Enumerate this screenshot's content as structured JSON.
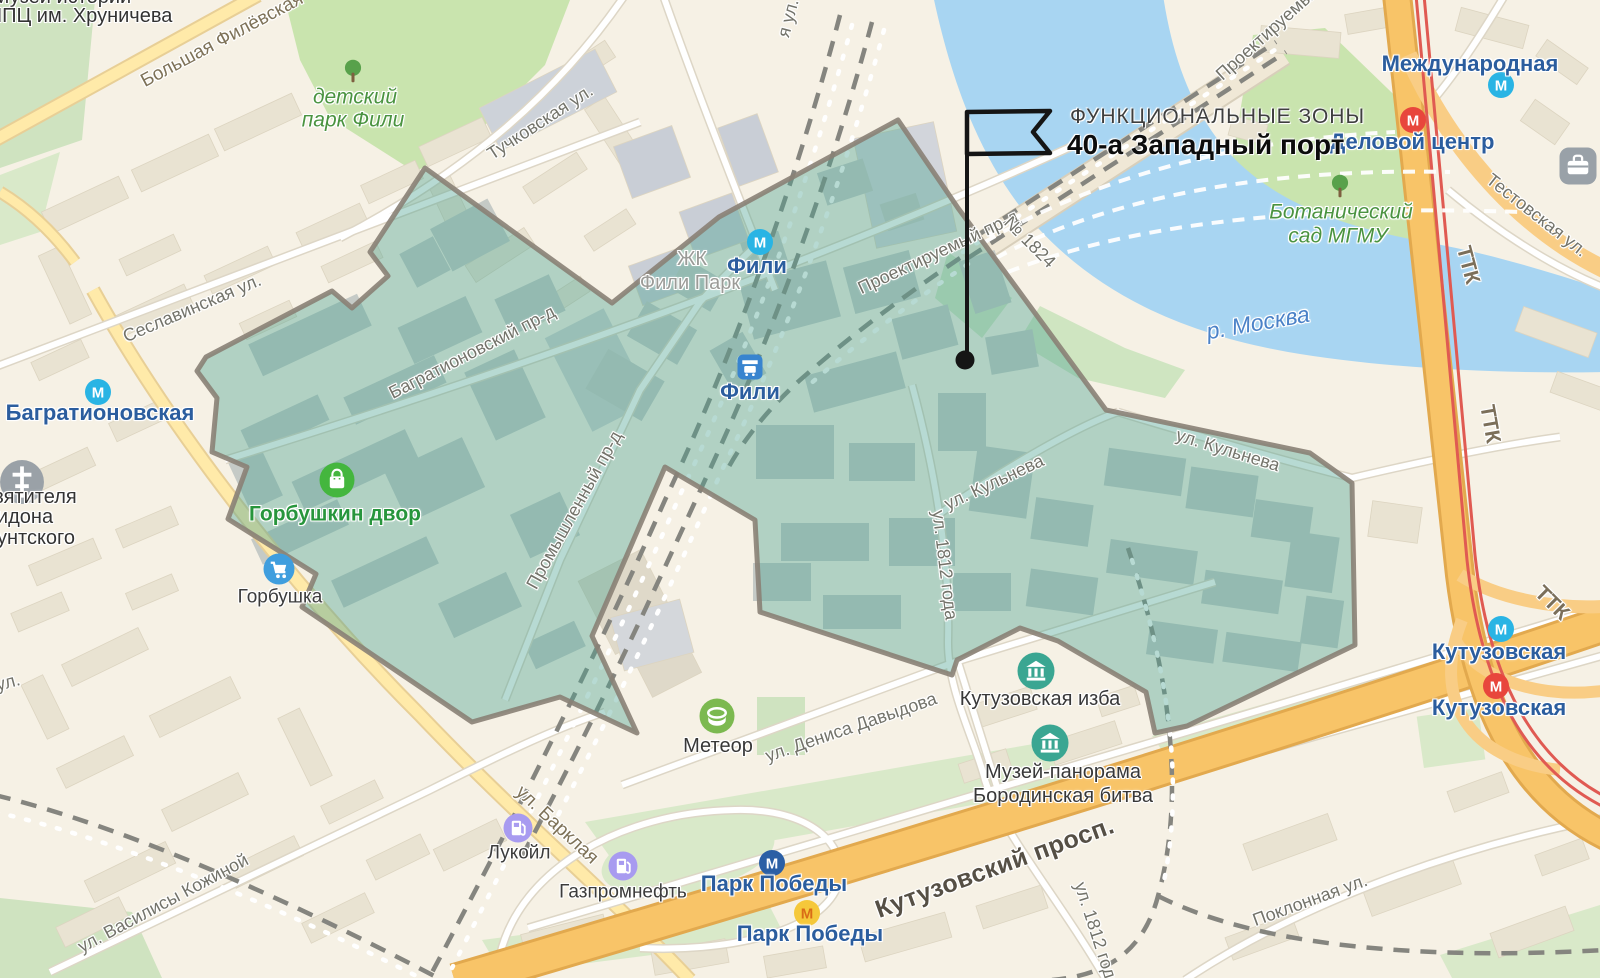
{
  "annotation": {
    "kicker": "ФУНКЦИОНАЛЬНЫЕ ЗОНЫ",
    "title": "40-а Западный порт"
  },
  "zone": {
    "name": "40-а Западный порт",
    "fill": "rgba(75,162,146,0.4)",
    "stroke": "#8a8175"
  },
  "map": {
    "labels": [
      {
        "name": "poi-label-museum-history-line1",
        "text": "Музей истории",
        "x": 62,
        "y": -3,
        "rot": 0,
        "cls": "dark",
        "inter": false
      },
      {
        "name": "poi-label-museum-history-line2",
        "text": "НПЦ им. Хруничева",
        "x": 80,
        "y": 16,
        "rot": 0,
        "cls": "dark",
        "inter": false
      },
      {
        "name": "road-label-bolshaya-filyovskaya",
        "text": "Большая Филёвская",
        "x": 222,
        "y": 40,
        "rot": -28,
        "cls": "road",
        "inter": false
      },
      {
        "name": "park-label-detskiy-line1",
        "text": "детский",
        "x": 355,
        "y": 97,
        "rot": 0,
        "cls": "park",
        "inter": true
      },
      {
        "name": "park-label-detskiy-line2",
        "text": "парк Фили",
        "x": 353,
        "y": 120,
        "rot": 0,
        "cls": "park",
        "inter": true
      },
      {
        "name": "street-label-tuchkovskaya",
        "text": "Тучковская ул.",
        "x": 540,
        "y": 122,
        "rot": -33,
        "cls": "street",
        "inter": false
      },
      {
        "name": "street-label-ya-ul",
        "text": "я ул.",
        "x": 788,
        "y": 18,
        "rot": -75,
        "cls": "street",
        "inter": false
      },
      {
        "name": "street-label-seslavinskaya",
        "text": "Сеславинская ул.",
        "x": 192,
        "y": 308,
        "rot": -23,
        "cls": "street",
        "inter": false
      },
      {
        "name": "metro-label-bagrationovskaya",
        "text": "Багратионовская",
        "x": 100,
        "y": 413,
        "rot": 0,
        "cls": "metro",
        "inter": true
      },
      {
        "name": "poi-label-church-line1",
        "text": "вятителя",
        "x": 35,
        "y": 497,
        "rot": 0,
        "cls": "dark",
        "inter": false
      },
      {
        "name": "poi-label-church-line2",
        "text": "идона",
        "x": 25,
        "y": 517,
        "rot": 0,
        "cls": "dark",
        "inter": false
      },
      {
        "name": "poi-label-church-line3",
        "text": "унтского",
        "x": 36,
        "y": 538,
        "rot": 0,
        "cls": "dark",
        "inter": false
      },
      {
        "name": "street-label-ul-left",
        "text": "ул.",
        "x": 8,
        "y": 682,
        "rot": -15,
        "cls": "street",
        "inter": false
      },
      {
        "name": "road-label-barklaya",
        "text": "ул. Барклая",
        "x": 557,
        "y": 825,
        "rot": 43,
        "cls": "road",
        "inter": false
      },
      {
        "name": "street-label-vasilisy-kozhinoy",
        "text": "ул. Василисы Кожиной",
        "x": 163,
        "y": 903,
        "rot": -28,
        "cls": "street",
        "inter": false
      },
      {
        "name": "poi-label-gorbushkin-dvor",
        "text": "Горбушкин двор",
        "x": 335,
        "y": 514,
        "rot": 0,
        "cls": "green-poi",
        "inter": true
      },
      {
        "name": "poi-label-gorbushka",
        "text": "Горбушка",
        "x": 280,
        "y": 597,
        "rot": 0,
        "cls": "poi",
        "inter": true
      },
      {
        "name": "poi-label-zhk-line1",
        "text": "ЖК",
        "x": 692,
        "y": 259,
        "rot": 0,
        "cls": "gray",
        "inter": false
      },
      {
        "name": "poi-label-zhk-line2",
        "text": "Фили Парк",
        "x": 690,
        "y": 283,
        "rot": 0,
        "cls": "gray",
        "inter": false
      },
      {
        "name": "metro-label-fili",
        "text": "Фили",
        "x": 757,
        "y": 266,
        "rot": 0,
        "cls": "metro",
        "inter": true
      },
      {
        "name": "station-label-fili",
        "text": "Фили",
        "x": 750,
        "y": 392,
        "rot": 0,
        "cls": "metro",
        "inter": true
      },
      {
        "name": "street-label-bagrationovsky",
        "text": "Багратионовский пр-д",
        "x": 472,
        "y": 352,
        "rot": -27,
        "cls": "street",
        "inter": false
      },
      {
        "name": "street-label-promyshlenny",
        "text": "Промышленный пр-д",
        "x": 574,
        "y": 510,
        "rot": -61,
        "cls": "street",
        "inter": false
      },
      {
        "name": "street-label-proektiruemy",
        "text": "Проектируемый пр-д",
        "x": 938,
        "y": 252,
        "rot": -25,
        "cls": "street",
        "inter": false
      },
      {
        "name": "street-label-proektiruemy-num",
        "text": "№ 1824",
        "x": 1030,
        "y": 242,
        "rot": 45,
        "cls": "street",
        "inter": false
      },
      {
        "name": "street-label-proektiruemy-2",
        "text": "Проектируемый",
        "x": 1268,
        "y": 32,
        "rot": -42,
        "cls": "street",
        "inter": false
      },
      {
        "name": "water-label-moskva",
        "text": "р. Москва",
        "x": 1258,
        "y": 323,
        "rot": -10,
        "cls": "water",
        "inter": false
      },
      {
        "name": "park-label-botsad-line1",
        "text": "Ботанический",
        "x": 1341,
        "y": 212,
        "rot": 0,
        "cls": "park",
        "inter": true
      },
      {
        "name": "park-label-botsad-line2",
        "text": "сад МГМУ",
        "x": 1338,
        "y": 236,
        "rot": 0,
        "cls": "park",
        "inter": true
      },
      {
        "name": "metro-label-delovoy-centr",
        "text": "Деловой центр",
        "x": 1412,
        "y": 142,
        "rot": 0,
        "cls": "metro",
        "inter": true
      },
      {
        "name": "metro-label-mezhdunarodnaya",
        "text": "Международная",
        "x": 1470,
        "y": 64,
        "rot": 0,
        "cls": "metro",
        "inter": true
      },
      {
        "name": "street-label-testovskaya",
        "text": "Тестовская ул.",
        "x": 1537,
        "y": 215,
        "rot": 38,
        "cls": "street",
        "inter": false
      },
      {
        "name": "road-label-ttk-1",
        "text": "ТТК",
        "x": 1468,
        "y": 265,
        "rot": 75,
        "cls": "ttk",
        "inter": false
      },
      {
        "name": "road-label-ttk-2",
        "text": "ТТК",
        "x": 1490,
        "y": 424,
        "rot": 80,
        "cls": "ttk",
        "inter": false
      },
      {
        "name": "road-label-ttk-3",
        "text": "ТТК",
        "x": 1552,
        "y": 603,
        "rot": 45,
        "cls": "ttk",
        "inter": false
      },
      {
        "name": "street-label-kulneva-w",
        "text": "ул. Кульнева",
        "x": 994,
        "y": 482,
        "rot": -25,
        "cls": "street",
        "inter": false
      },
      {
        "name": "street-label-kulneva-e",
        "text": "ул. Кульнева",
        "x": 1228,
        "y": 450,
        "rot": 17,
        "cls": "street",
        "inter": false
      },
      {
        "name": "street-label-1812-mid",
        "text": "ул. 1812 года",
        "x": 945,
        "y": 565,
        "rot": 83,
        "cls": "street",
        "inter": false
      },
      {
        "name": "street-label-1812-s",
        "text": "ул. 1812 года",
        "x": 1097,
        "y": 935,
        "rot": 72,
        "cls": "street",
        "inter": false
      },
      {
        "name": "street-label-denisa-davydova",
        "text": "ул. Дениса Давыдова",
        "x": 851,
        "y": 727,
        "rot": -19,
        "cls": "street",
        "inter": false
      },
      {
        "name": "poi-label-kutuzovskaya-izba",
        "text": "Кутузовская изба",
        "x": 1040,
        "y": 699,
        "rot": 0,
        "cls": "poi-lg",
        "inter": true
      },
      {
        "name": "poi-label-panorama-line1",
        "text": "Музей-панорама",
        "x": 1063,
        "y": 772,
        "rot": 0,
        "cls": "poi-lg",
        "inter": true
      },
      {
        "name": "poi-label-panorama-line2",
        "text": "Бородинская битва",
        "x": 1063,
        "y": 796,
        "rot": 0,
        "cls": "poi-lg",
        "inter": true
      },
      {
        "name": "poi-label-meteor",
        "text": "Метеор",
        "x": 718,
        "y": 746,
        "rot": 0,
        "cls": "poi-lg",
        "inter": true
      },
      {
        "name": "poi-label-lukoil",
        "text": "Лукойл",
        "x": 519,
        "y": 853,
        "rot": 0,
        "cls": "poi",
        "inter": true
      },
      {
        "name": "poi-label-gazpromneft",
        "text": "Газпромнефть",
        "x": 623,
        "y": 892,
        "rot": 0,
        "cls": "poi",
        "inter": true
      },
      {
        "name": "metro-label-park-pobedy-1",
        "text": "Парк Победы",
        "x": 774,
        "y": 884,
        "rot": 0,
        "cls": "metro",
        "inter": true
      },
      {
        "name": "metro-label-park-pobedy-2",
        "text": "Парк Победы",
        "x": 810,
        "y": 934,
        "rot": 0,
        "cls": "metro",
        "inter": true
      },
      {
        "name": "road-label-kutuzovsky",
        "text": "Кутузовский просп.",
        "x": 995,
        "y": 868,
        "rot": -20,
        "cls": "major",
        "inter": false
      },
      {
        "name": "metro-label-kutuzovskaya-1",
        "text": "Кутузовская",
        "x": 1499,
        "y": 652,
        "rot": 0,
        "cls": "metro",
        "inter": true
      },
      {
        "name": "metro-label-kutuzovskaya-2",
        "text": "Кутузовская",
        "x": 1499,
        "y": 708,
        "rot": 0,
        "cls": "metro",
        "inter": true
      },
      {
        "name": "street-label-poklonnaya",
        "text": "Поклонная ул.",
        "x": 1310,
        "y": 900,
        "rot": -20,
        "cls": "street",
        "inter": false
      }
    ],
    "icons": [
      {
        "name": "metro-icon-bagrationovskaya",
        "kind": "metro",
        "x": 98,
        "y": 392,
        "bg": "#29b4e4",
        "fg": "#fff",
        "letter": "М"
      },
      {
        "name": "metro-icon-fili",
        "kind": "metro",
        "x": 760,
        "y": 242,
        "bg": "#29b4e4",
        "fg": "#fff",
        "letter": "М"
      },
      {
        "name": "train-station-icon-fili",
        "kind": "train",
        "x": 750,
        "y": 367,
        "bg": "#3884cf",
        "fg": "#fff"
      },
      {
        "name": "metro-icon-park-pobedy-blue",
        "kind": "metro",
        "x": 772,
        "y": 863,
        "bg": "#2b5fa5",
        "fg": "#fff",
        "letter": "М"
      },
      {
        "name": "metro-icon-park-pobedy-yellow",
        "kind": "metro",
        "x": 807,
        "y": 913,
        "bg": "#f5c83a",
        "fg": "#d96c17",
        "letter": "М"
      },
      {
        "name": "metro-icon-kutuzovskaya-blue",
        "kind": "metro",
        "x": 1501,
        "y": 629,
        "bg": "#29b4e4",
        "fg": "#fff",
        "letter": "М"
      },
      {
        "name": "metro-icon-kutuzovskaya-red",
        "kind": "metro",
        "x": 1496,
        "y": 686,
        "bg": "#e8463c",
        "fg": "#fff",
        "letter": "М"
      },
      {
        "name": "metro-icon-delovoy-centr",
        "kind": "metro",
        "x": 1413,
        "y": 120,
        "bg": "#e8463c",
        "fg": "#fff",
        "letter": "М"
      },
      {
        "name": "metro-icon-mezhdunarodnaya",
        "kind": "metro",
        "x": 1501,
        "y": 85,
        "bg": "#29b4e4",
        "fg": "#fff",
        "letter": "М"
      },
      {
        "name": "church-icon",
        "kind": "church",
        "x": 22,
        "y": 482,
        "bg": "#9aa1a7",
        "fg": "#fff"
      },
      {
        "name": "shopping-bag-icon-gorbushkin-dvor",
        "kind": "bag",
        "x": 337,
        "y": 480,
        "bg": "#44b63e",
        "fg": "#fff"
      },
      {
        "name": "shopping-cart-icon-gorbushka",
        "kind": "cart",
        "x": 279,
        "y": 569,
        "bg": "#3f9ede",
        "fg": "#fff"
      },
      {
        "name": "fuel-pump-icon-lukoil",
        "kind": "pump",
        "x": 518,
        "y": 828,
        "bg": "#a89bf0",
        "fg": "#fff"
      },
      {
        "name": "fuel-pump-icon-gazpromneft",
        "kind": "pump",
        "x": 623,
        "y": 866,
        "bg": "#a89bf0",
        "fg": "#fff"
      },
      {
        "name": "museum-icon-kutuzovskaya-izba",
        "kind": "museum",
        "x": 1036,
        "y": 671,
        "bg": "#3aa692",
        "fg": "#fff"
      },
      {
        "name": "museum-icon-panorama",
        "kind": "museum",
        "x": 1050,
        "y": 743,
        "bg": "#3aa692",
        "fg": "#fff"
      },
      {
        "name": "stadium-icon-meteor",
        "kind": "stadium",
        "x": 717,
        "y": 716,
        "bg": "#7cb950",
        "fg": "#fff"
      },
      {
        "name": "tree-icon-detskiy-park",
        "kind": "tree",
        "x": 353,
        "y": 71,
        "bg": "#58a14b",
        "fg": "#7e5f40"
      },
      {
        "name": "tree-icon-botsad",
        "kind": "tree",
        "x": 1340,
        "y": 186,
        "bg": "#58a14b",
        "fg": "#7e5f40"
      },
      {
        "name": "briefcase-icon-business",
        "kind": "case",
        "x": 1578,
        "y": 166,
        "bg": "#99a1a8",
        "fg": "#fff"
      }
    ]
  }
}
